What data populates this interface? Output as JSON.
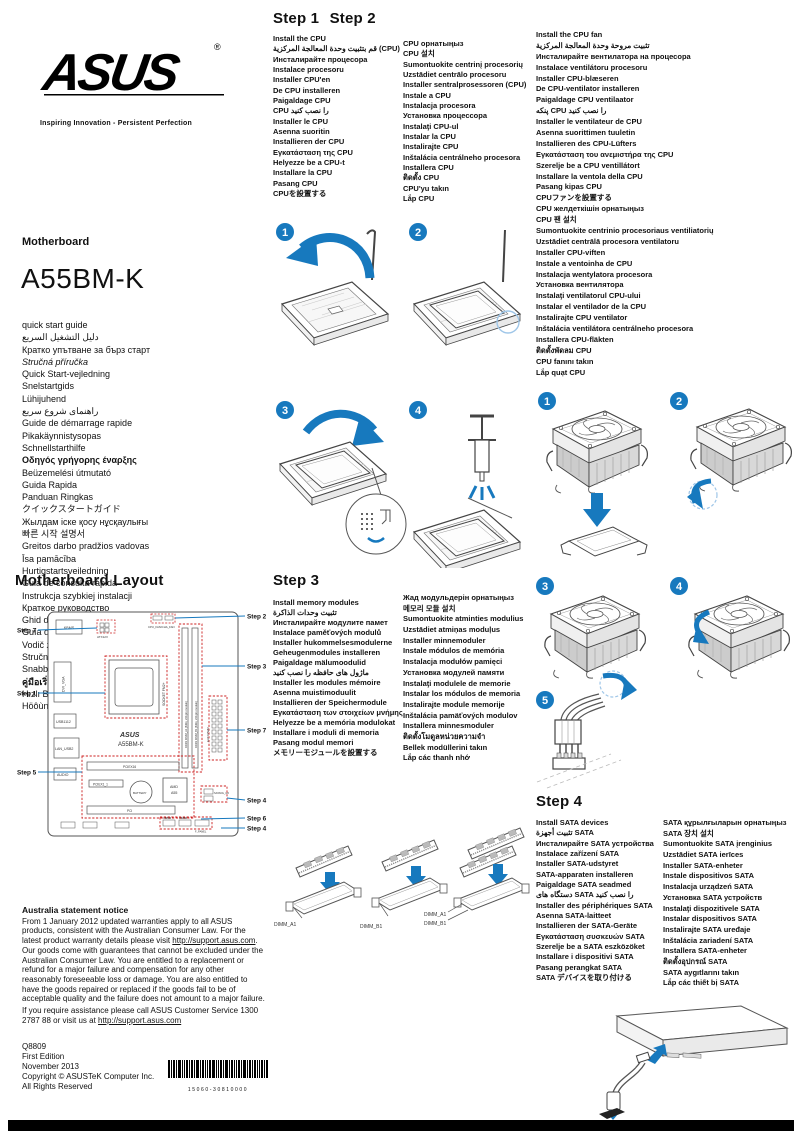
{
  "page": {
    "accent_blue": "#1779be",
    "highlight_red": "#cc2222"
  },
  "brand": {
    "logo": "ASUS",
    "registered": "®",
    "tagline": "Inspiring Innovation - Persistent Perfection",
    "product_type": "Motherboard",
    "model": "A55BM-K"
  },
  "titles": {
    "items": [
      {
        "t": "quick start guide"
      },
      {
        "t": "دليل التشغيل السريع"
      },
      {
        "t": "Кратко упътване за бърз старт"
      },
      {
        "t": "Stručná příručka",
        "i": true
      },
      {
        "t": "Quick Start-vejledning"
      },
      {
        "t": "Snelstartgids"
      },
      {
        "t": "Lühijuhend"
      },
      {
        "t": "راهنمای شروع سریع"
      },
      {
        "t": "Guide de démarrage rapide"
      },
      {
        "t": "Pikakäynnistysopas"
      },
      {
        "t": "Schnellstarthilfe"
      },
      {
        "t": "Οδηγός γρήγορης έναρξης",
        "b": true
      },
      {
        "t": "Beüzemelési útmutató"
      },
      {
        "t": "Guida Rapida"
      },
      {
        "t": "Panduan Ringkas"
      },
      {
        "t": "クイックスタートガイド"
      },
      {
        "t": "Жылдам іске қосу нұсқаулығы"
      },
      {
        "t": "빠른 시작 설명서"
      },
      {
        "t": "Greitos darbo pradžios vadovas"
      },
      {
        "t": "Īsa pamācība"
      },
      {
        "t": "Hurtigstartsveiledning"
      },
      {
        "t": "Guia de consulta rápida"
      },
      {
        "t": "Instrukcja szybkiej instalacji"
      },
      {
        "t": "Краткое руководство"
      },
      {
        "t": "Ghid de pornire rapidă"
      },
      {
        "t": "Guía de inicio rápida"
      },
      {
        "t": "Vodič za brzo korišćenje"
      },
      {
        "t": "Stručný návod na spustenie"
      },
      {
        "t": "Snabbstartsguide"
      },
      {
        "t": "คู่มือเริ่มต้นอย่างเร็ว",
        "b": true
      },
      {
        "t": "Hızlı Başlatma Kılavuzu"
      },
      {
        "t": "Höôùng daãn khôûi ñoäng nhanh"
      }
    ]
  },
  "steps12": {
    "heading1": "Step 1",
    "heading2": "Step 2",
    "col1": [
      "Install the CPU",
      "قم بتثبيت وحدة المعالجة المركزية (CPU)",
      "Инсталирайте процесора",
      "Instalace procesoru",
      "Installer CPU'en",
      "De CPU installeren",
      "Paigaldage CPU",
      "CPU را نصب كنيد",
      "Installer le CPU",
      "Asenna suoritin",
      "Installieren der CPU",
      "Εγκατάσταση της CPU",
      "Helyezze be a CPU-t",
      "Installare la CPU",
      "Pasang CPU",
      "CPUを設置する"
    ],
    "col2": [
      "CPU орнатыңыз",
      "CPU 설치",
      "Sumontuokite centrinį procesorių",
      "Uzstādiet centrālo procesoru",
      "Installer sentralprosessoren (CPU)",
      "Instale a CPU",
      "Instalacja procesora",
      "Установка процессора",
      "Instalaţi CPU-ul",
      "Instalar la CPU",
      "Instalirajte CPU",
      "Inštalácia centrálneho procesora",
      "Installera CPU",
      "ติดตั้ง CPU",
      "CPU'yu takın",
      "Lắp CPU"
    ]
  },
  "step2_fan": {
    "col": [
      "Install the CPU fan",
      "تثبيت مروحة وحدة المعالجة المركزية",
      "Инсталирайте вентилатора на процесора",
      "Instalace ventilátoru procesoru",
      "Installer CPU-blæseren",
      "De CPU-ventilator installeren",
      "Paigaldage CPU ventilaator",
      "پنکه CPU را نصب کنید",
      "Installer le ventilateur de CPU",
      "Asenna suorittimen tuuletin",
      "Installieren des CPU-Lüfters",
      "Εγκατάσταση του ανεμιστήρα της CPU",
      "Szerelje be a CPU ventillátort",
      "Installare la ventola della CPU",
      "Pasang kipas CPU",
      "CPUファンを設置する",
      "CPU желдеткішін орнатыңыз",
      "CPU 팬 설치",
      "Sumontuokite centrinio procesoriaus ventiliatorių",
      "Uzstādiet centrālā procesora ventilatoru",
      "Installer CPU-viften",
      "Instale a ventoinha de CPU",
      "Instalacja wentylatora procesora",
      "Установка вентилятора",
      "Instalaţi ventilatorul CPU-ului",
      "Instalar el ventilador de la CPU",
      "Instalirajte CPU ventilator",
      "Inštalácia ventilátora centrálneho procesora",
      "Installera CPU-fläkten",
      "ติดตั้งพัดลม CPU",
      "CPU fanını takın",
      "Lắp quạt CPU"
    ]
  },
  "step3": {
    "heading": "Step 3",
    "col1": [
      "Install memory modules",
      "تثبيت وحدات الذاكرة",
      "Инсталирайте модулите памет",
      "Instalace paměťových modulů",
      "Installer hukommelsesmodulerne",
      "Geheugenmodules installeren",
      "Paigaldage mälumoodulid",
      "ماژول های حافظه را نصب کنید",
      "Installer les modules mémoire",
      "Asenna muistimoduulit",
      "Installieren der Speichermodule",
      "Εγκατάσταση των στοιχείων μνήμης",
      "Helyezze be a memória modulokat",
      "Installare i moduli di memoria",
      "Pasang modul memori",
      "メモリーモジュールを設置する"
    ],
    "col2": [
      "Жад модульдерін орнатыңыз",
      "메모리 모듈 설치",
      "Sumontuokite atminties modulius",
      "Uzstādiet atmiņas moduļus",
      "Installer minnemoduler",
      "Instale módulos de memória",
      "Instalacja modułów pamięci",
      "Установка модулей памяти",
      "Instalaţi modulele de memorie",
      "Instalar los módulos de memoria",
      "Instalirajte module memorije",
      "Inštalácia pamäťových modulov",
      "Installera minnesmoduler",
      "ติดตั้งโมดูลหน่วยความจำ",
      "Bellek modüllerini takın",
      "Lắp các thanh nhớ"
    ]
  },
  "step4": {
    "heading": "Step 4",
    "col1": [
      "Install SATA devices",
      "تثبيت أجهزة SATA",
      "Инсталирайте SATA устройства",
      "Instalace zařízení SATA",
      "Installer SATA-udstyret",
      "SATA-apparaten installeren",
      "Paigaldage SATA seadmed",
      "دستگاه های SATA را نصب کنید",
      "Installer des périphériques SATA",
      "Asenna SATA-laitteet",
      "Installieren der SATA-Geräte",
      "Εγκατάσταση συσκευών SATA",
      "Szerelje be a SATA eszközöket",
      "Installare i dispositivi SATA",
      "Pasang perangkat SATA",
      "SATA デバイスを取り付ける"
    ],
    "col2": [
      "SATA құрылғыларын орнатыңыз",
      "SATA 장치 설치",
      "Sumontuokite SATA įrenginius",
      "Uzstādiet SATA ierīces",
      "Installer SATA-enheter",
      "Instale dispositivos SATA",
      "Instalacja urządzeń SATA",
      "Установка SATA устройств",
      "Instalaţi dispozitivele SATA",
      "Instalar dispositivos SATA",
      "Instalirajte SATA uređaje",
      "Inštalácia zariadení SATA",
      "Installera SATA-enheter",
      "ติดตั้งอุปกรณ์ SATA",
      "SATA aygıtlarını takın",
      "Lắp các thiết bị SATA"
    ]
  },
  "diagrams": {
    "cpu_steps": [
      "1",
      "2",
      "3",
      "4"
    ],
    "fan_steps": [
      "1",
      "2",
      "3",
      "4",
      "5"
    ],
    "dimm_labels": [
      "DIMM_A1",
      "DIMM_B1"
    ]
  },
  "mb": {
    "heading": "Motherboard Layout",
    "brand": "ASUS",
    "model": "A55BM-K",
    "components": {
      "kbms": "KBMS",
      "dvi_vga": "DVI_VGA",
      "usb1112": "USB1112",
      "lan_usb2": "LAN_USB2",
      "audio": "AUDIO",
      "atx12v": "ATX12V",
      "cpu_fan": "CPU_FAN/CHA_FAN",
      "socket": "SOCKET FM2+",
      "dimm_a1": "DDR3 DIMM_A1 (64bit, 240-pin module)",
      "dimm_b1": "DDR3 DIMM_B1 (64bit, 240-pin module)",
      "eatxpwr": "EATXPWR",
      "pciex16": "PCIEX16",
      "pciex1": "PCIEX1_1",
      "pci": "PCI",
      "battery": "BATTERY",
      "chipset_l1": "AMD",
      "chipset_l2": "A55",
      "sata": "SATA6G_1/2",
      "usb34": "USB34",
      "usb56": "USB56",
      "f_panel": "F_PANEL"
    },
    "callouts": [
      {
        "label": "Step 2",
        "side": "right"
      },
      {
        "label": "Step 7",
        "side": "left"
      },
      {
        "label": "Step 3",
        "side": "right"
      },
      {
        "label": "Step 1",
        "side": "left"
      },
      {
        "label": "Step 7",
        "side": "right"
      },
      {
        "label": "Step 5",
        "side": "left"
      },
      {
        "label": "Step 4",
        "side": "right"
      },
      {
        "label": "Step 6",
        "side": "right"
      },
      {
        "label": "Step 4",
        "side": "right"
      }
    ]
  },
  "australia": {
    "heading": "Australia statement notice",
    "p1a": "From 1 January 2012 updated warranties apply to all ASUS products, consistent with the Australian Consumer Law. For the latest product warranty details please visit ",
    "p1link": "http://support.asus.com",
    "p1b": ". Our goods come with guarantees that cannot be excluded under the Australian Consumer Law. You are entitled to a replacement or refund for a major failure and compensation for any other reasonably foreseeable loss or damage. You are also entitled to have the goods repaired or replaced if the goods fail to be of acceptable quality and the failure does not amount to a major failure.",
    "p2a": "If you require assistance please call ASUS Customer Service 1300 2787 88 or visit us at ",
    "p2link": "http://support.asus.com"
  },
  "footer": {
    "doc_no": "Q8809",
    "edition": "First Edition",
    "date": "November 2013",
    "copyright": "Copyright © ASUSTeK Computer Inc.",
    "rights": "All Rights Reserved",
    "barcode_text": "15060-30810000"
  }
}
